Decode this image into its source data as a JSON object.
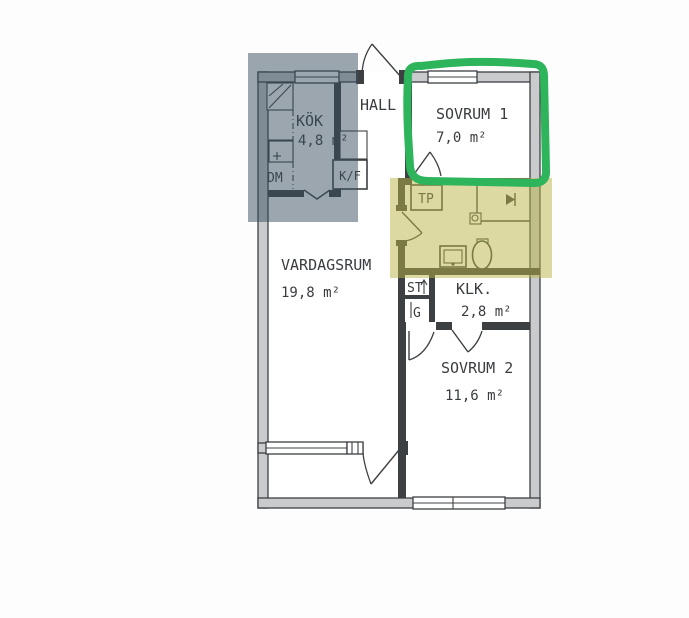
{
  "rooms": {
    "kok": {
      "name": "KÖK",
      "area": "4,8 m²"
    },
    "hall": {
      "name": "HALL"
    },
    "sovrum1": {
      "name": "SOVRUM 1",
      "area": "7,0 m²"
    },
    "vardagsrum": {
      "name": "VARDAGSRUM",
      "area": "19,8 m²"
    },
    "klk": {
      "name": "KLK.",
      "area": "2,8 m²"
    },
    "sovrum2": {
      "name": "SOVRUM 2",
      "area": "11,6 m²"
    }
  },
  "labels": {
    "dm": "DM",
    "kf": "K/F",
    "tp": "TP",
    "st": "ST",
    "g": "G"
  },
  "colors": {
    "highlight_green": "#2eb45a",
    "kitchen_overlay": "rgba(56,78,94,0.5)",
    "bathroom_overlay": "rgba(185,179,69,0.5)",
    "wall_dark": "#3c4043",
    "wall_fill": "#c9cbcd"
  }
}
